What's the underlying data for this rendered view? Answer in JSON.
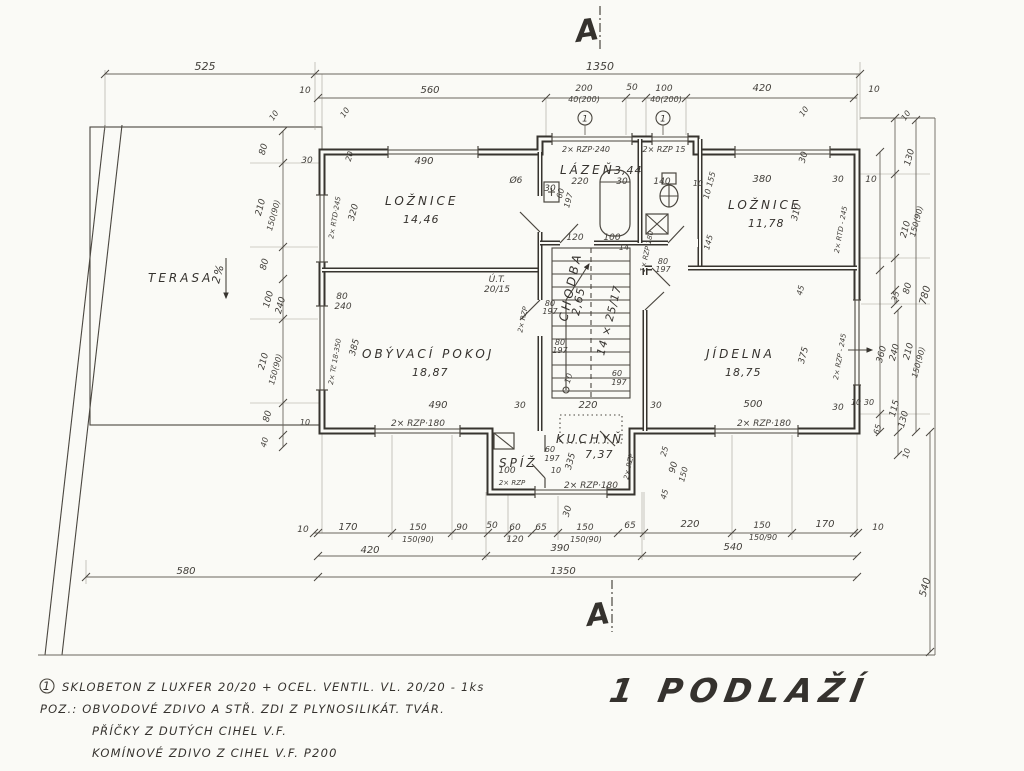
{
  "palette": {
    "paper": "#fafaf6",
    "ink": "#37342f",
    "text": "#35322e"
  },
  "title": {
    "label": "1 PODLAŽÍ"
  },
  "section_marks": {
    "top": "A",
    "bottom": "A"
  },
  "rooms": [
    {
      "name": "TERASA",
      "area": ""
    },
    {
      "name": "LOŽNICE",
      "area": "14,46"
    },
    {
      "name": "LÁZEŇ",
      "area": "3,44"
    },
    {
      "name": "LOŽNICE",
      "area": "11,78"
    },
    {
      "name": "OBÝVACÍ POKOJ",
      "area": "18,87"
    },
    {
      "name": "CHODBA",
      "area": "2,65"
    },
    {
      "name": "JÍDELNA",
      "area": "18,75"
    },
    {
      "name": "KUCHYŇ",
      "area": "7,37"
    },
    {
      "name": "SPÍŽ",
      "area": ""
    }
  ],
  "stairs": {
    "label": "14 × 25/17"
  },
  "terrace": {
    "slope_label": "2%"
  },
  "notes": {
    "mark": "1",
    "line1": "SKLOBETON Z LUXFER 20/20 + OCEL. VENTIL. VL. 20/20 - 1ks",
    "line2": "POZ.:  OBVODOVÉ ZDIVO A STŘ. ZDI  Z PLYNOSILIKÁT. TVÁR.",
    "line3": "PŘÍČKY Z DUTÝCH CIHEL V.F.",
    "line4": "KOMÍNOVÉ ZDIVO Z CIHEL V.F. P200"
  },
  "dim_labels": [
    {
      "t": "525",
      "x": 205,
      "y": 70,
      "s": 11
    },
    {
      "t": "1350",
      "x": 600,
      "y": 70,
      "s": 11
    },
    {
      "t": "10",
      "x": 305,
      "y": 93,
      "s": 9
    },
    {
      "t": "560",
      "x": 430,
      "y": 93,
      "s": 10
    },
    {
      "t": "200",
      "x": 584,
      "y": 91,
      "s": 9
    },
    {
      "t": "40(200)",
      "x": 584,
      "y": 102,
      "s": 8
    },
    {
      "t": "50",
      "x": 632,
      "y": 90,
      "s": 9
    },
    {
      "t": "100",
      "x": 664,
      "y": 91,
      "s": 9
    },
    {
      "t": "40(200)",
      "x": 666,
      "y": 102,
      "s": 8
    },
    {
      "t": "420",
      "x": 762,
      "y": 91,
      "s": 10
    },
    {
      "t": "10",
      "x": 874,
      "y": 92,
      "s": 9
    },
    {
      "t": "10",
      "x": 276,
      "y": 117,
      "s": 8,
      "r": -55
    },
    {
      "t": "10",
      "x": 347,
      "y": 114,
      "s": 8,
      "r": -55
    },
    {
      "t": "10",
      "x": 806,
      "y": 113,
      "s": 8,
      "r": -55
    },
    {
      "t": "10",
      "x": 908,
      "y": 117,
      "s": 8,
      "r": -55
    },
    {
      "t": "80",
      "x": 266,
      "y": 150,
      "r": -75,
      "s": 9
    },
    {
      "t": "30",
      "x": 307,
      "y": 163,
      "s": 9
    },
    {
      "t": "210",
      "x": 263,
      "y": 208,
      "r": -75,
      "s": 9
    },
    {
      "t": "150(90)",
      "x": 276,
      "y": 216,
      "r": -75,
      "s": 8
    },
    {
      "t": "80",
      "x": 267,
      "y": 265,
      "r": -75,
      "s": 9
    },
    {
      "t": "100",
      "x": 271,
      "y": 300,
      "r": -75,
      "s": 9
    },
    {
      "t": "240",
      "x": 283,
      "y": 306,
      "r": -75,
      "s": 9
    },
    {
      "t": "210",
      "x": 266,
      "y": 362,
      "r": -75,
      "s": 9
    },
    {
      "t": "150(90)",
      "x": 278,
      "y": 370,
      "r": -75,
      "s": 8
    },
    {
      "t": "80",
      "x": 270,
      "y": 417,
      "r": -75,
      "s": 9
    },
    {
      "t": "10",
      "x": 305,
      "y": 425,
      "s": 8
    },
    {
      "t": "40",
      "x": 267,
      "y": 443,
      "r": -75,
      "s": 8
    },
    {
      "t": "490",
      "x": 424,
      "y": 164,
      "s": 10
    },
    {
      "t": "20",
      "x": 352,
      "y": 157,
      "r": -75,
      "s": 8
    },
    {
      "t": "320",
      "x": 356,
      "y": 213,
      "r": -75,
      "s": 9
    },
    {
      "t": "2× RTD·245",
      "x": 337,
      "y": 218,
      "r": -80,
      "s": 7
    },
    {
      "t": "Ø6",
      "x": 516,
      "y": 183,
      "s": 9
    },
    {
      "t": "30",
      "x": 550,
      "y": 191,
      "s": 9
    },
    {
      "t": "2× RZP·240",
      "x": 586,
      "y": 152,
      "s": 8
    },
    {
      "t": "2× RZP 15",
      "x": 664,
      "y": 152,
      "s": 8
    },
    {
      "t": "220",
      "x": 580,
      "y": 184,
      "s": 9
    },
    {
      "t": "30",
      "x": 622,
      "y": 184,
      "s": 9
    },
    {
      "t": "140",
      "x": 662,
      "y": 184,
      "s": 9
    },
    {
      "t": "10",
      "x": 698,
      "y": 186,
      "s": 8
    },
    {
      "t": "10 155",
      "x": 712,
      "y": 186,
      "r": -75,
      "s": 8
    },
    {
      "t": "60",
      "x": 563,
      "y": 194,
      "r": -75,
      "s": 8
    },
    {
      "t": "197",
      "x": 571,
      "y": 201,
      "r": -75,
      "s": 8
    },
    {
      "t": "120",
      "x": 575,
      "y": 240,
      "s": 9
    },
    {
      "t": "100",
      "x": 612,
      "y": 240,
      "s": 9
    },
    {
      "t": "14",
      "x": 624,
      "y": 250,
      "s": 8
    },
    {
      "t": "145",
      "x": 711,
      "y": 243,
      "r": -75,
      "s": 8
    },
    {
      "t": "1× RZP·180",
      "x": 649,
      "y": 252,
      "r": -78,
      "s": 7
    },
    {
      "t": "380",
      "x": 762,
      "y": 182,
      "s": 10
    },
    {
      "t": "30",
      "x": 838,
      "y": 182,
      "s": 9
    },
    {
      "t": "10",
      "x": 871,
      "y": 182,
      "s": 9
    },
    {
      "t": "30",
      "x": 806,
      "y": 158,
      "r": -75,
      "s": 9
    },
    {
      "t": "310",
      "x": 799,
      "y": 213,
      "r": -75,
      "s": 9
    },
    {
      "t": "2× RTD - 245",
      "x": 843,
      "y": 230,
      "r": -80,
      "s": 7
    },
    {
      "t": "Ú.T.",
      "x": 497,
      "y": 282,
      "s": 9
    },
    {
      "t": "20/15",
      "x": 497,
      "y": 292,
      "s": 9
    },
    {
      "t": "80",
      "x": 342,
      "y": 299,
      "s": 9
    },
    {
      "t": "240",
      "x": 343,
      "y": 309,
      "s": 9
    },
    {
      "t": "385",
      "x": 357,
      "y": 348,
      "r": -75,
      "s": 9
    },
    {
      "t": "2× Tč 18-350",
      "x": 337,
      "y": 362,
      "r": -80,
      "s": 7
    },
    {
      "t": "490",
      "x": 438,
      "y": 408,
      "s": 10
    },
    {
      "t": "30",
      "x": 520,
      "y": 408,
      "s": 9
    },
    {
      "t": "2× RZP·180",
      "x": 418,
      "y": 426,
      "s": 9
    },
    {
      "t": "2× RZP",
      "x": 525,
      "y": 320,
      "r": -78,
      "s": 7
    },
    {
      "t": "80",
      "x": 550,
      "y": 306,
      "s": 8
    },
    {
      "t": "197",
      "x": 550,
      "y": 314,
      "s": 8
    },
    {
      "t": "80",
      "x": 560,
      "y": 345,
      "s": 8
    },
    {
      "t": "197",
      "x": 560,
      "y": 353,
      "s": 8
    },
    {
      "t": "10",
      "x": 571,
      "y": 379,
      "r": -75,
      "s": 8
    },
    {
      "t": "60",
      "x": 617,
      "y": 376,
      "s": 8
    },
    {
      "t": "197",
      "x": 619,
      "y": 385,
      "s": 8
    },
    {
      "t": "220",
      "x": 588,
      "y": 408,
      "s": 10
    },
    {
      "t": "30",
      "x": 656,
      "y": 408,
      "s": 9
    },
    {
      "t": "80",
      "x": 663,
      "y": 264,
      "s": 8
    },
    {
      "t": "197",
      "x": 663,
      "y": 272,
      "s": 8
    },
    {
      "t": "500",
      "x": 753,
      "y": 407,
      "s": 10
    },
    {
      "t": "30",
      "x": 838,
      "y": 410,
      "s": 9
    },
    {
      "t": "2× RZP·180",
      "x": 764,
      "y": 426,
      "s": 9
    },
    {
      "t": "375",
      "x": 806,
      "y": 356,
      "r": -75,
      "s": 9
    },
    {
      "t": "45",
      "x": 803,
      "y": 291,
      "r": -75,
      "s": 8
    },
    {
      "t": "2× RZP - 245",
      "x": 842,
      "y": 357,
      "r": -80,
      "s": 7
    },
    {
      "t": "10",
      "x": 856,
      "y": 405,
      "s": 8
    },
    {
      "t": "30",
      "x": 869,
      "y": 405,
      "s": 8
    },
    {
      "t": "60",
      "x": 550,
      "y": 452,
      "s": 8
    },
    {
      "t": "197",
      "x": 552,
      "y": 461,
      "s": 8
    },
    {
      "t": "100",
      "x": 507,
      "y": 473,
      "s": 9
    },
    {
      "t": "10",
      "x": 556,
      "y": 473,
      "s": 8
    },
    {
      "t": "2× RZP",
      "x": 512,
      "y": 485,
      "s": 7
    },
    {
      "t": "2× RZP·180",
      "x": 591,
      "y": 488,
      "s": 9
    },
    {
      "t": "335",
      "x": 573,
      "y": 462,
      "r": -75,
      "s": 9
    },
    {
      "t": "30",
      "x": 570,
      "y": 512,
      "r": -75,
      "s": 9
    },
    {
      "t": "2× RZP",
      "x": 631,
      "y": 467,
      "r": -78,
      "s": 7
    },
    {
      "t": "25",
      "x": 667,
      "y": 452,
      "r": -75,
      "s": 8
    },
    {
      "t": "90",
      "x": 676,
      "y": 468,
      "r": -75,
      "s": 9
    },
    {
      "t": "150",
      "x": 686,
      "y": 475,
      "r": -75,
      "s": 8
    },
    {
      "t": "45",
      "x": 667,
      "y": 495,
      "r": -75,
      "s": 8
    },
    {
      "t": "10",
      "x": 303,
      "y": 532,
      "s": 9
    },
    {
      "t": "170",
      "x": 348,
      "y": 530,
      "s": 10
    },
    {
      "t": "150",
      "x": 418,
      "y": 530,
      "s": 9
    },
    {
      "t": "150(90)",
      "x": 418,
      "y": 542,
      "s": 8
    },
    {
      "t": "90",
      "x": 462,
      "y": 530,
      "s": 9
    },
    {
      "t": "50",
      "x": 492,
      "y": 528,
      "s": 9
    },
    {
      "t": "60",
      "x": 515,
      "y": 530,
      "s": 9
    },
    {
      "t": "120",
      "x": 515,
      "y": 542,
      "s": 9
    },
    {
      "t": "65",
      "x": 541,
      "y": 530,
      "s": 9
    },
    {
      "t": "150",
      "x": 585,
      "y": 530,
      "s": 9
    },
    {
      "t": "150(90)",
      "x": 586,
      "y": 542,
      "s": 8
    },
    {
      "t": "65",
      "x": 630,
      "y": 528,
      "s": 9
    },
    {
      "t": "220",
      "x": 690,
      "y": 527,
      "s": 10
    },
    {
      "t": "150",
      "x": 762,
      "y": 528,
      "s": 9
    },
    {
      "t": "150/90",
      "x": 763,
      "y": 540,
      "s": 8
    },
    {
      "t": "170",
      "x": 825,
      "y": 527,
      "s": 10
    },
    {
      "t": "10",
      "x": 878,
      "y": 530,
      "s": 9
    },
    {
      "t": "420",
      "x": 370,
      "y": 553,
      "s": 10
    },
    {
      "t": "390",
      "x": 560,
      "y": 551,
      "s": 10
    },
    {
      "t": "540",
      "x": 733,
      "y": 550,
      "s": 10
    },
    {
      "t": "1350",
      "x": 563,
      "y": 574,
      "s": 10
    },
    {
      "t": "580",
      "x": 186,
      "y": 574,
      "s": 10
    },
    {
      "t": "130",
      "x": 912,
      "y": 158,
      "r": -75,
      "s": 9
    },
    {
      "t": "210",
      "x": 908,
      "y": 230,
      "r": -75,
      "s": 9
    },
    {
      "t": "150(90)",
      "x": 919,
      "y": 222,
      "r": -75,
      "s": 8
    },
    {
      "t": "80",
      "x": 910,
      "y": 289,
      "r": -75,
      "s": 9
    },
    {
      "t": "35",
      "x": 898,
      "y": 297,
      "r": -75,
      "s": 8
    },
    {
      "t": "780",
      "x": 928,
      "y": 296,
      "r": -75,
      "s": 10
    },
    {
      "t": "360",
      "x": 884,
      "y": 355,
      "r": -75,
      "s": 9
    },
    {
      "t": "240",
      "x": 897,
      "y": 353,
      "r": -75,
      "s": 9
    },
    {
      "t": "210",
      "x": 911,
      "y": 352,
      "r": -75,
      "s": 9
    },
    {
      "t": "150(90)",
      "x": 921,
      "y": 363,
      "r": -75,
      "s": 8
    },
    {
      "t": "115",
      "x": 897,
      "y": 409,
      "r": -75,
      "s": 9
    },
    {
      "t": "130",
      "x": 906,
      "y": 420,
      "r": -75,
      "s": 9
    },
    {
      "t": "65",
      "x": 880,
      "y": 430,
      "r": -75,
      "s": 8
    },
    {
      "t": "10",
      "x": 909,
      "y": 454,
      "r": -75,
      "s": 8
    },
    {
      "t": "540",
      "x": 928,
      "y": 588,
      "r": -75,
      "s": 10
    }
  ]
}
